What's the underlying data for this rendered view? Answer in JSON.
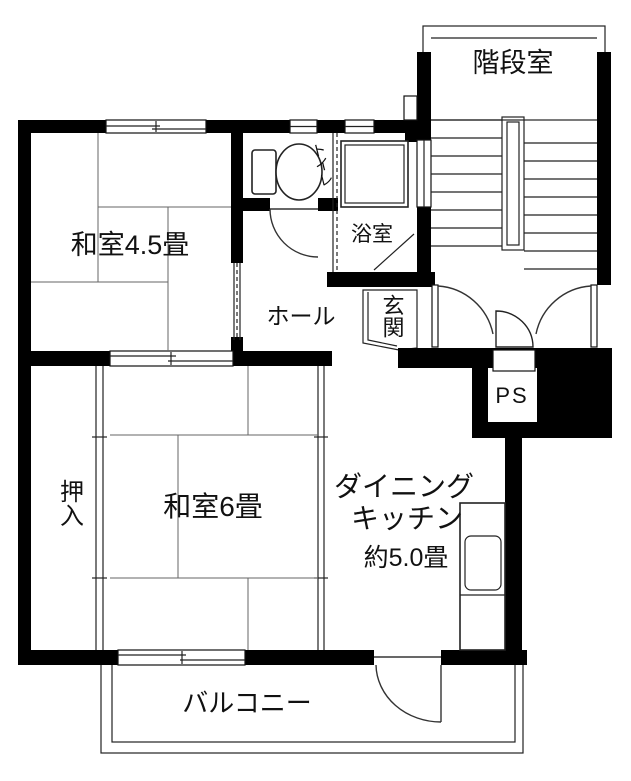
{
  "plan": {
    "title": "apartment-floor-plan",
    "rooms": {
      "stairwell": "階段室",
      "toilet": "トイレ",
      "bath": "浴室",
      "hall": "ホール",
      "entrance": "玄関",
      "pipe_space": "PS",
      "japanese_room_45": "和室4.5畳",
      "closet": "押入",
      "japanese_room_6": "和室6畳",
      "dining_kitchen_line1": "ダイニング",
      "dining_kitchen_line2": "キッチン",
      "dining_kitchen_size": "約5.0畳",
      "balcony": "バルコニー"
    },
    "colors": {
      "wall": "#000000",
      "floor": "#ffffff",
      "line": "#333333"
    }
  }
}
